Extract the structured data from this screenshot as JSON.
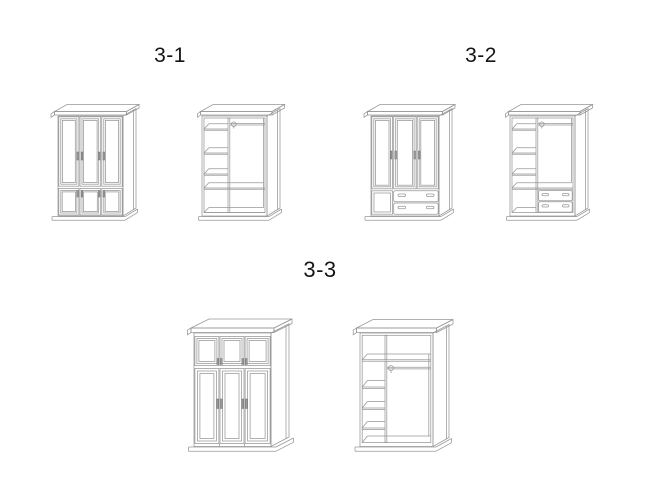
{
  "page": {
    "type": "wardrobe-diagram-sheet",
    "background": "#ffffff"
  },
  "colors": {
    "background": "#ffffff",
    "line": "#979797",
    "handle_fill": "#9a9a9a",
    "handle_stroke": "#6e6e6e",
    "label_text": "#151515"
  },
  "sections": [
    {
      "id": "3-1",
      "label": "3-1",
      "views": [
        {
          "name": "front-exterior-three-doors-with-lower-doors"
        },
        {
          "name": "interior-shelf-column-hanging-rod-open-bottom"
        }
      ]
    },
    {
      "id": "3-2",
      "label": "3-2",
      "views": [
        {
          "name": "front-exterior-three-doors-lower-door-two-drawers"
        },
        {
          "name": "interior-shelf-column-hanging-rod-two-drawers"
        }
      ]
    },
    {
      "id": "3-3",
      "label": "3-3",
      "views": [
        {
          "name": "front-exterior-top-compartment-doors-three-tall-doors"
        },
        {
          "name": "interior-top-shelf-shelf-column-hanging-rod"
        }
      ]
    }
  ]
}
